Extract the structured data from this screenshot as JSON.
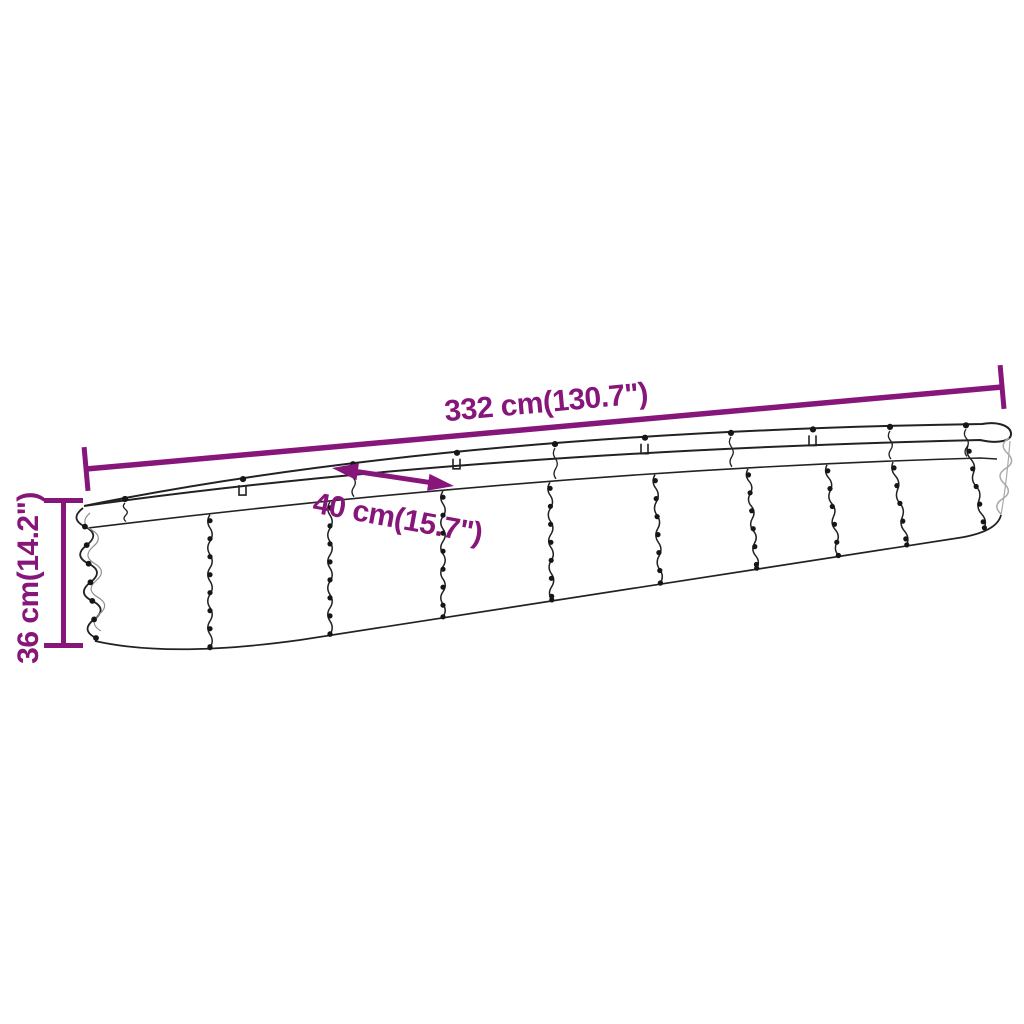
{
  "figure": {
    "labels": {
      "length": "332 cm(130.7\")",
      "width": "40 cm(15.7\")",
      "height": "36 cm(14.2\")"
    },
    "colors": {
      "dimension": "#86167a",
      "outline": "#222222",
      "outline_light": "#a8a8a8",
      "background": "#ffffff"
    }
  }
}
